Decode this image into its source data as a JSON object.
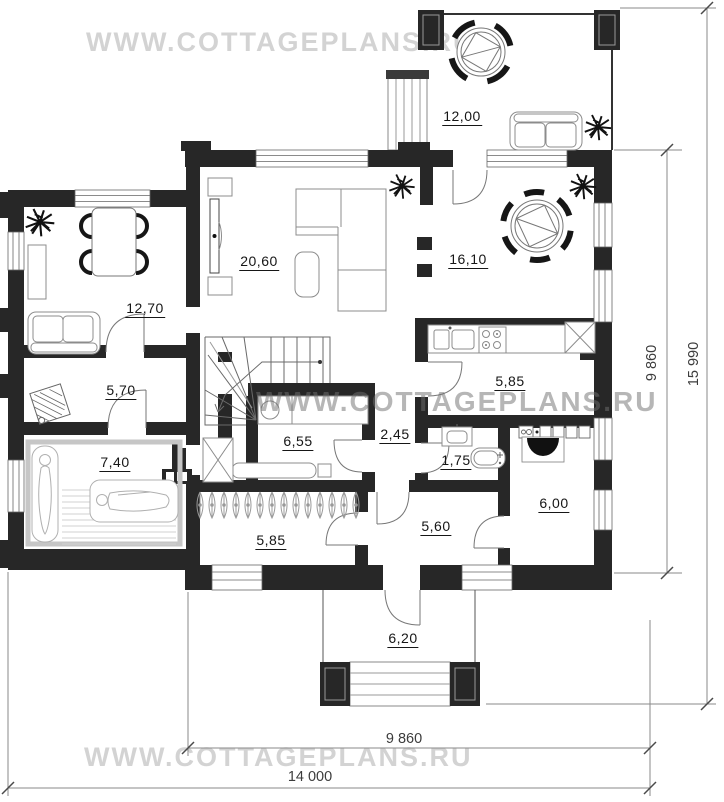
{
  "watermarks": {
    "top": "WWW.COTTAGEPLANS.RU",
    "middle": "WWW.COTTAGEPLANS.RU",
    "bottom": "WWW.COTTAGEPLANS.RU"
  },
  "rooms": [
    {
      "name": "terrace",
      "area": "12,00"
    },
    {
      "name": "lounge",
      "area": "12,70"
    },
    {
      "name": "living-room",
      "area": "20,60"
    },
    {
      "name": "dining-room",
      "area": "16,10"
    },
    {
      "name": "washroom",
      "area": "5,70"
    },
    {
      "name": "sauna",
      "area": "7,40"
    },
    {
      "name": "relax-room",
      "area": "6,55"
    },
    {
      "name": "hallway",
      "area": "2,45"
    },
    {
      "name": "kitchen",
      "area": "5,85"
    },
    {
      "name": "bathroom",
      "area": "1,75"
    },
    {
      "name": "boiler-room",
      "area": "6,00"
    },
    {
      "name": "vestibule",
      "area": "5,60"
    },
    {
      "name": "entrance-hall",
      "area": "5,85"
    },
    {
      "name": "porch",
      "area": "6,20"
    }
  ],
  "dimensions": {
    "height_inner": "9 860",
    "height_outer": "15 990",
    "width_inner": "9 860",
    "width_outer": "14 000"
  },
  "colors": {
    "wall": "#272727",
    "furniture_line": "#8c8c8c",
    "door_arc": "#777777",
    "dimension_line": "#888888",
    "watermark_light": "#d3d3d3",
    "watermark_dark": "#6f6f6f"
  }
}
